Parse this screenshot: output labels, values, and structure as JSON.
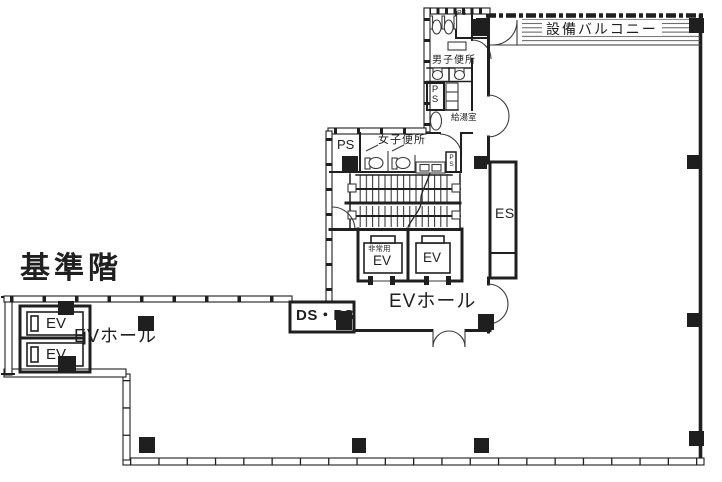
{
  "colors": {
    "wall": "#1f1f1f",
    "line": "#3a3a3a",
    "bg": "#ffffff",
    "ink": "#1f1f1f"
  },
  "labels": {
    "title": "基準階",
    "balcony": "設備バルコニー",
    "mens_toilet": "男子便所",
    "womens_toilet": "女子便所",
    "kitchenette": "給湯室",
    "ps_closet": "PS",
    "ps_vertical_mens": "PS",
    "ps_room": "PS",
    "ps_small_womens": "PS",
    "es": "ES",
    "emergency_prefix": "非常用",
    "ev": "EV",
    "ev_hall": "EVホール",
    "ds_ps": "DS・PS"
  }
}
